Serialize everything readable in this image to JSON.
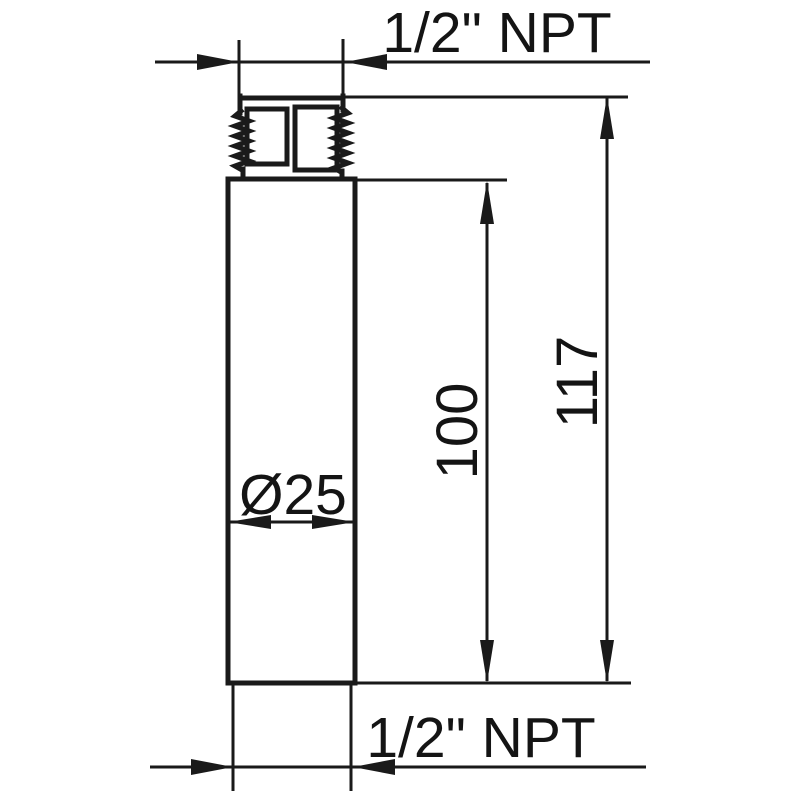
{
  "drawing": {
    "kind": "technical-dimension-drawing",
    "colors": {
      "line": "#1a1a1a",
      "background": "#ffffff"
    }
  },
  "dimensions": {
    "top_thread": {
      "label": "1/2\" NPT"
    },
    "overall_length": {
      "label": "117",
      "value": 117
    },
    "body_length": {
      "label": "100",
      "value": 100
    },
    "body_diameter": {
      "label": "Ø25",
      "value": 25
    },
    "bottom_thread": {
      "label": "1/2\" NPT"
    }
  }
}
